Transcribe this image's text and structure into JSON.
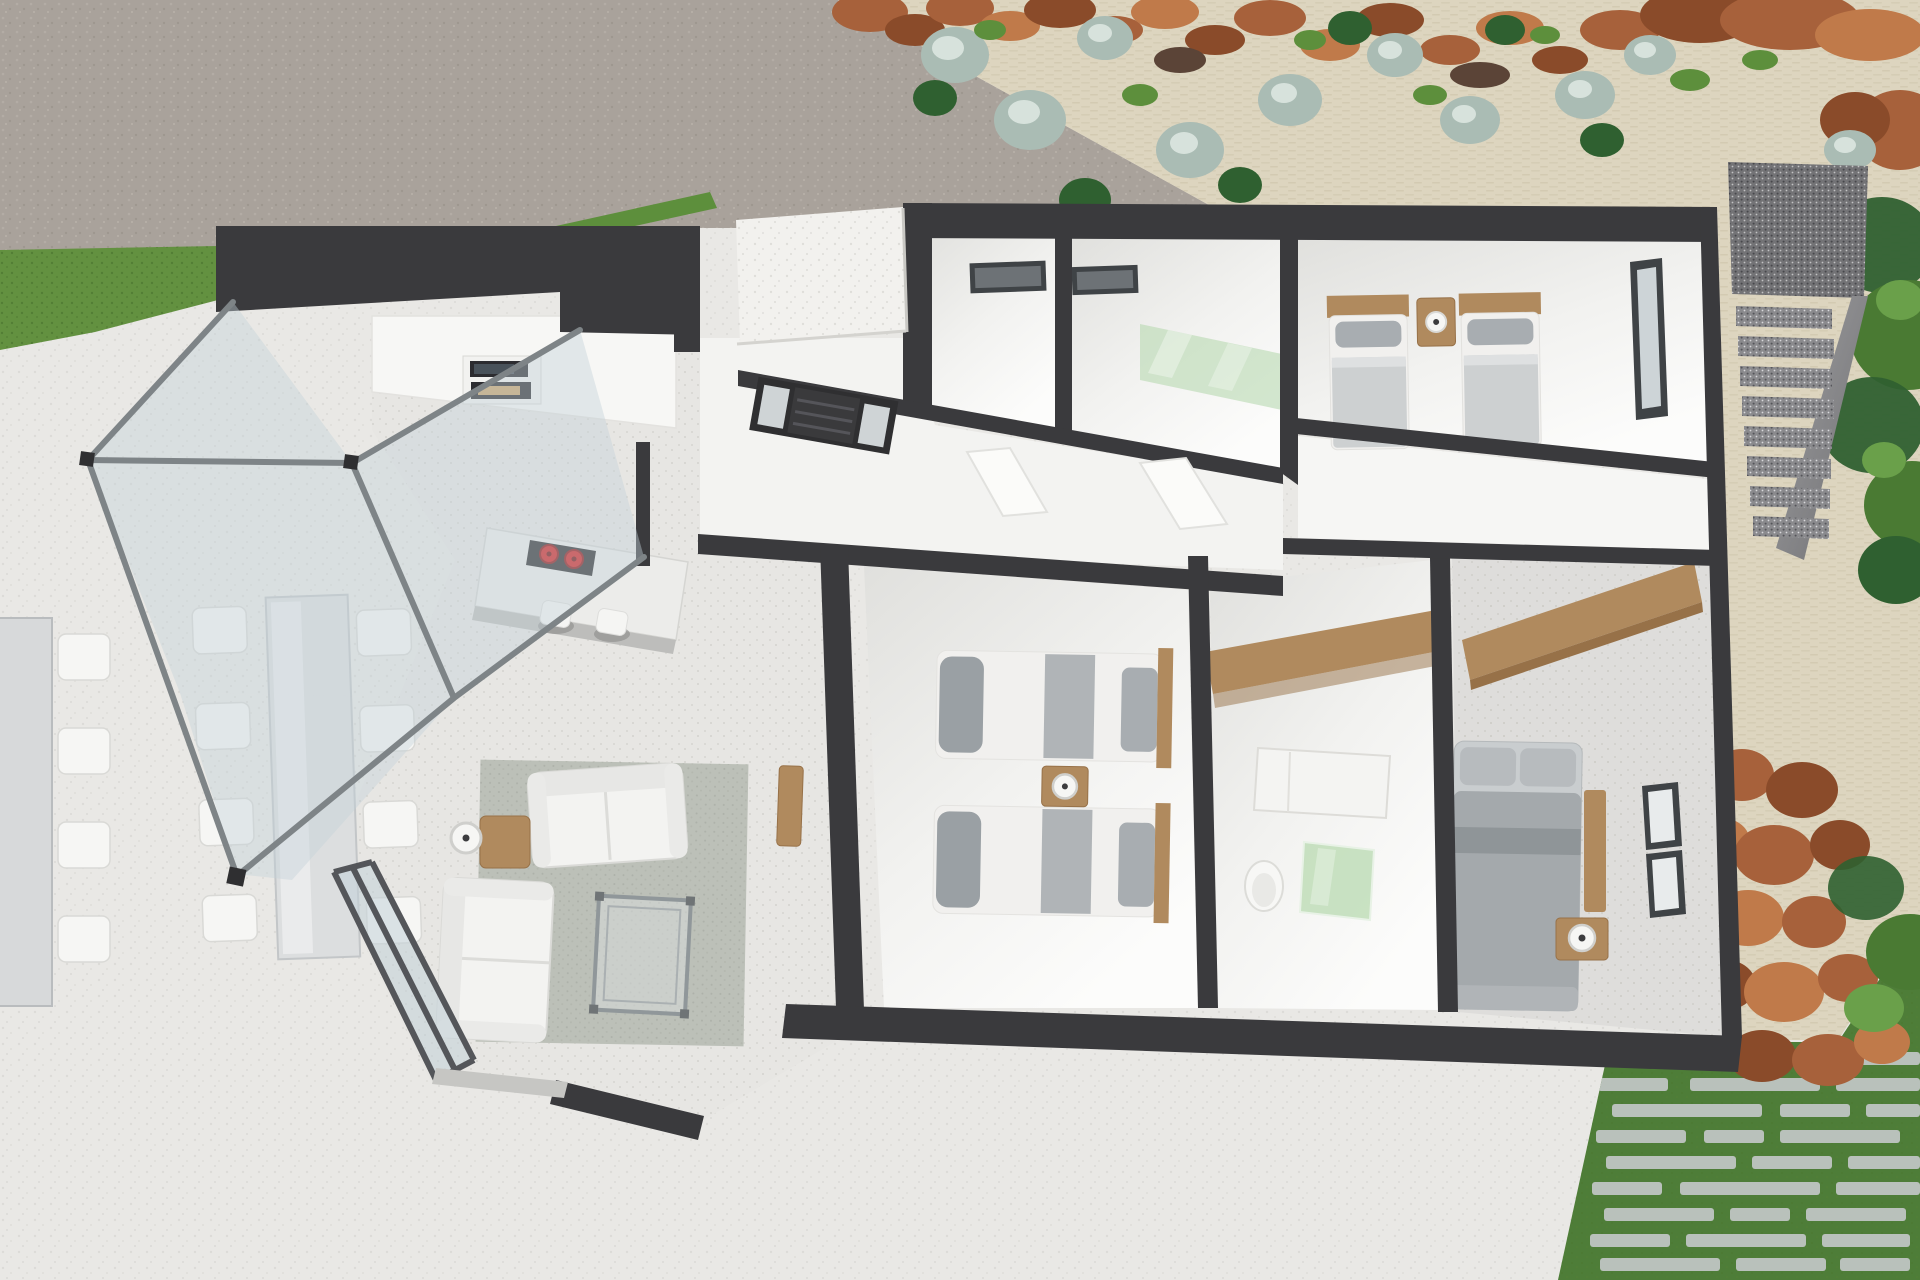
{
  "scene": {
    "type": "3d-floor-plan-render",
    "view": "top-down dollhouse view of a single-storey modern villa",
    "rooms": [
      {
        "name": "winter-garden-terrace",
        "furniture": [
          "glass-pergola",
          "dining-table-left",
          "dining-table-center",
          "twelve-white-chairs"
        ]
      },
      {
        "name": "kitchen",
        "furniture": [
          "tall-cabinet-wall",
          "built-in-oven",
          "built-in-microwave",
          "island-with-induction-hob",
          "two-red-burners",
          "two-bar-stools"
        ]
      },
      {
        "name": "living-room",
        "furniture": [
          "white-sofa-horizontal",
          "white-sofa-vertical",
          "wooden-side-table",
          "floor-lamp",
          "glass-coffee-table",
          "gray-rug",
          "wooden-sideboard",
          "glass-slider-door"
        ]
      },
      {
        "name": "entry-hall",
        "furniture": [
          "front-door-with-sidelights",
          "white-canopy-roof"
        ]
      },
      {
        "name": "hallway",
        "furniture": [
          "two-open-white-doors",
          "diagonal-walls"
        ]
      },
      {
        "name": "utility-room",
        "furniture": [
          "high-slot-window"
        ]
      },
      {
        "name": "shower-room",
        "furniture": [
          "green-glass-shower",
          "high-slot-window"
        ]
      },
      {
        "name": "twin-bedroom",
        "furniture": [
          "two-single-beds",
          "wooden-headboards",
          "shared-nightstand",
          "table-lamp",
          "tall-side-window"
        ]
      },
      {
        "name": "bedroom-two",
        "furniture": [
          "two-single-beds-horizontal",
          "wooden-headboards",
          "nightstand",
          "table-lamp"
        ]
      },
      {
        "name": "family-bathroom",
        "furniture": [
          "wooden-wardrobe-counter",
          "white-vanity",
          "toilet",
          "green-glass-shower"
        ]
      },
      {
        "name": "master-bedroom",
        "furniture": [
          "double-bed-gray-bedding",
          "wooden-wardrobe",
          "wooden-side-unit",
          "nightstand",
          "table-lamp",
          "two-windows",
          "speckled-gray-floor"
        ]
      }
    ],
    "exterior": [
      "concrete-driveway",
      "artificial-grass-strip",
      "white-stone-terrace",
      "cream-gravel-garden",
      "rock-and-shrub-border",
      "silver-green-shrubs",
      "gabion-staircase",
      "tree-canopy",
      "terracotta-rock-retaining-wall",
      "lawn-with-stone-pavers",
      "hedge-strip"
    ]
  },
  "colors": {
    "wall": "#3a3a3d",
    "terrace": "#e9e8e5",
    "driveway": "#a9a29b",
    "gravel": "#ddd5bf",
    "grass": "#639140",
    "lawn": "#4e7d38",
    "paver": "#b9c1bb",
    "rock": "#a7613b",
    "rock_dark": "#8a4b2a",
    "rock_light": "#c07a4a",
    "bush_gray": "#aabcb4",
    "bush_green": "#2f6030",
    "bush_mid": "#5d8f3c",
    "stair": "#87878a",
    "floor": "#e7e6e3",
    "entry_floor": "#f3f3f1",
    "glass": "#c3d2d8",
    "frame": "#7e8487",
    "wood": "#b08a5e",
    "wood_dark": "#977148",
    "fabric": "#a8adb1",
    "fabric_dark": "#8f9598",
    "sheet": "#f1f0ee",
    "rug": "#bcc0b8",
    "sofa": "#f3f3f1",
    "burner": "#cf1f1f",
    "shower_green": "#b8d9b0",
    "door_dark": "#2f2f31"
  }
}
